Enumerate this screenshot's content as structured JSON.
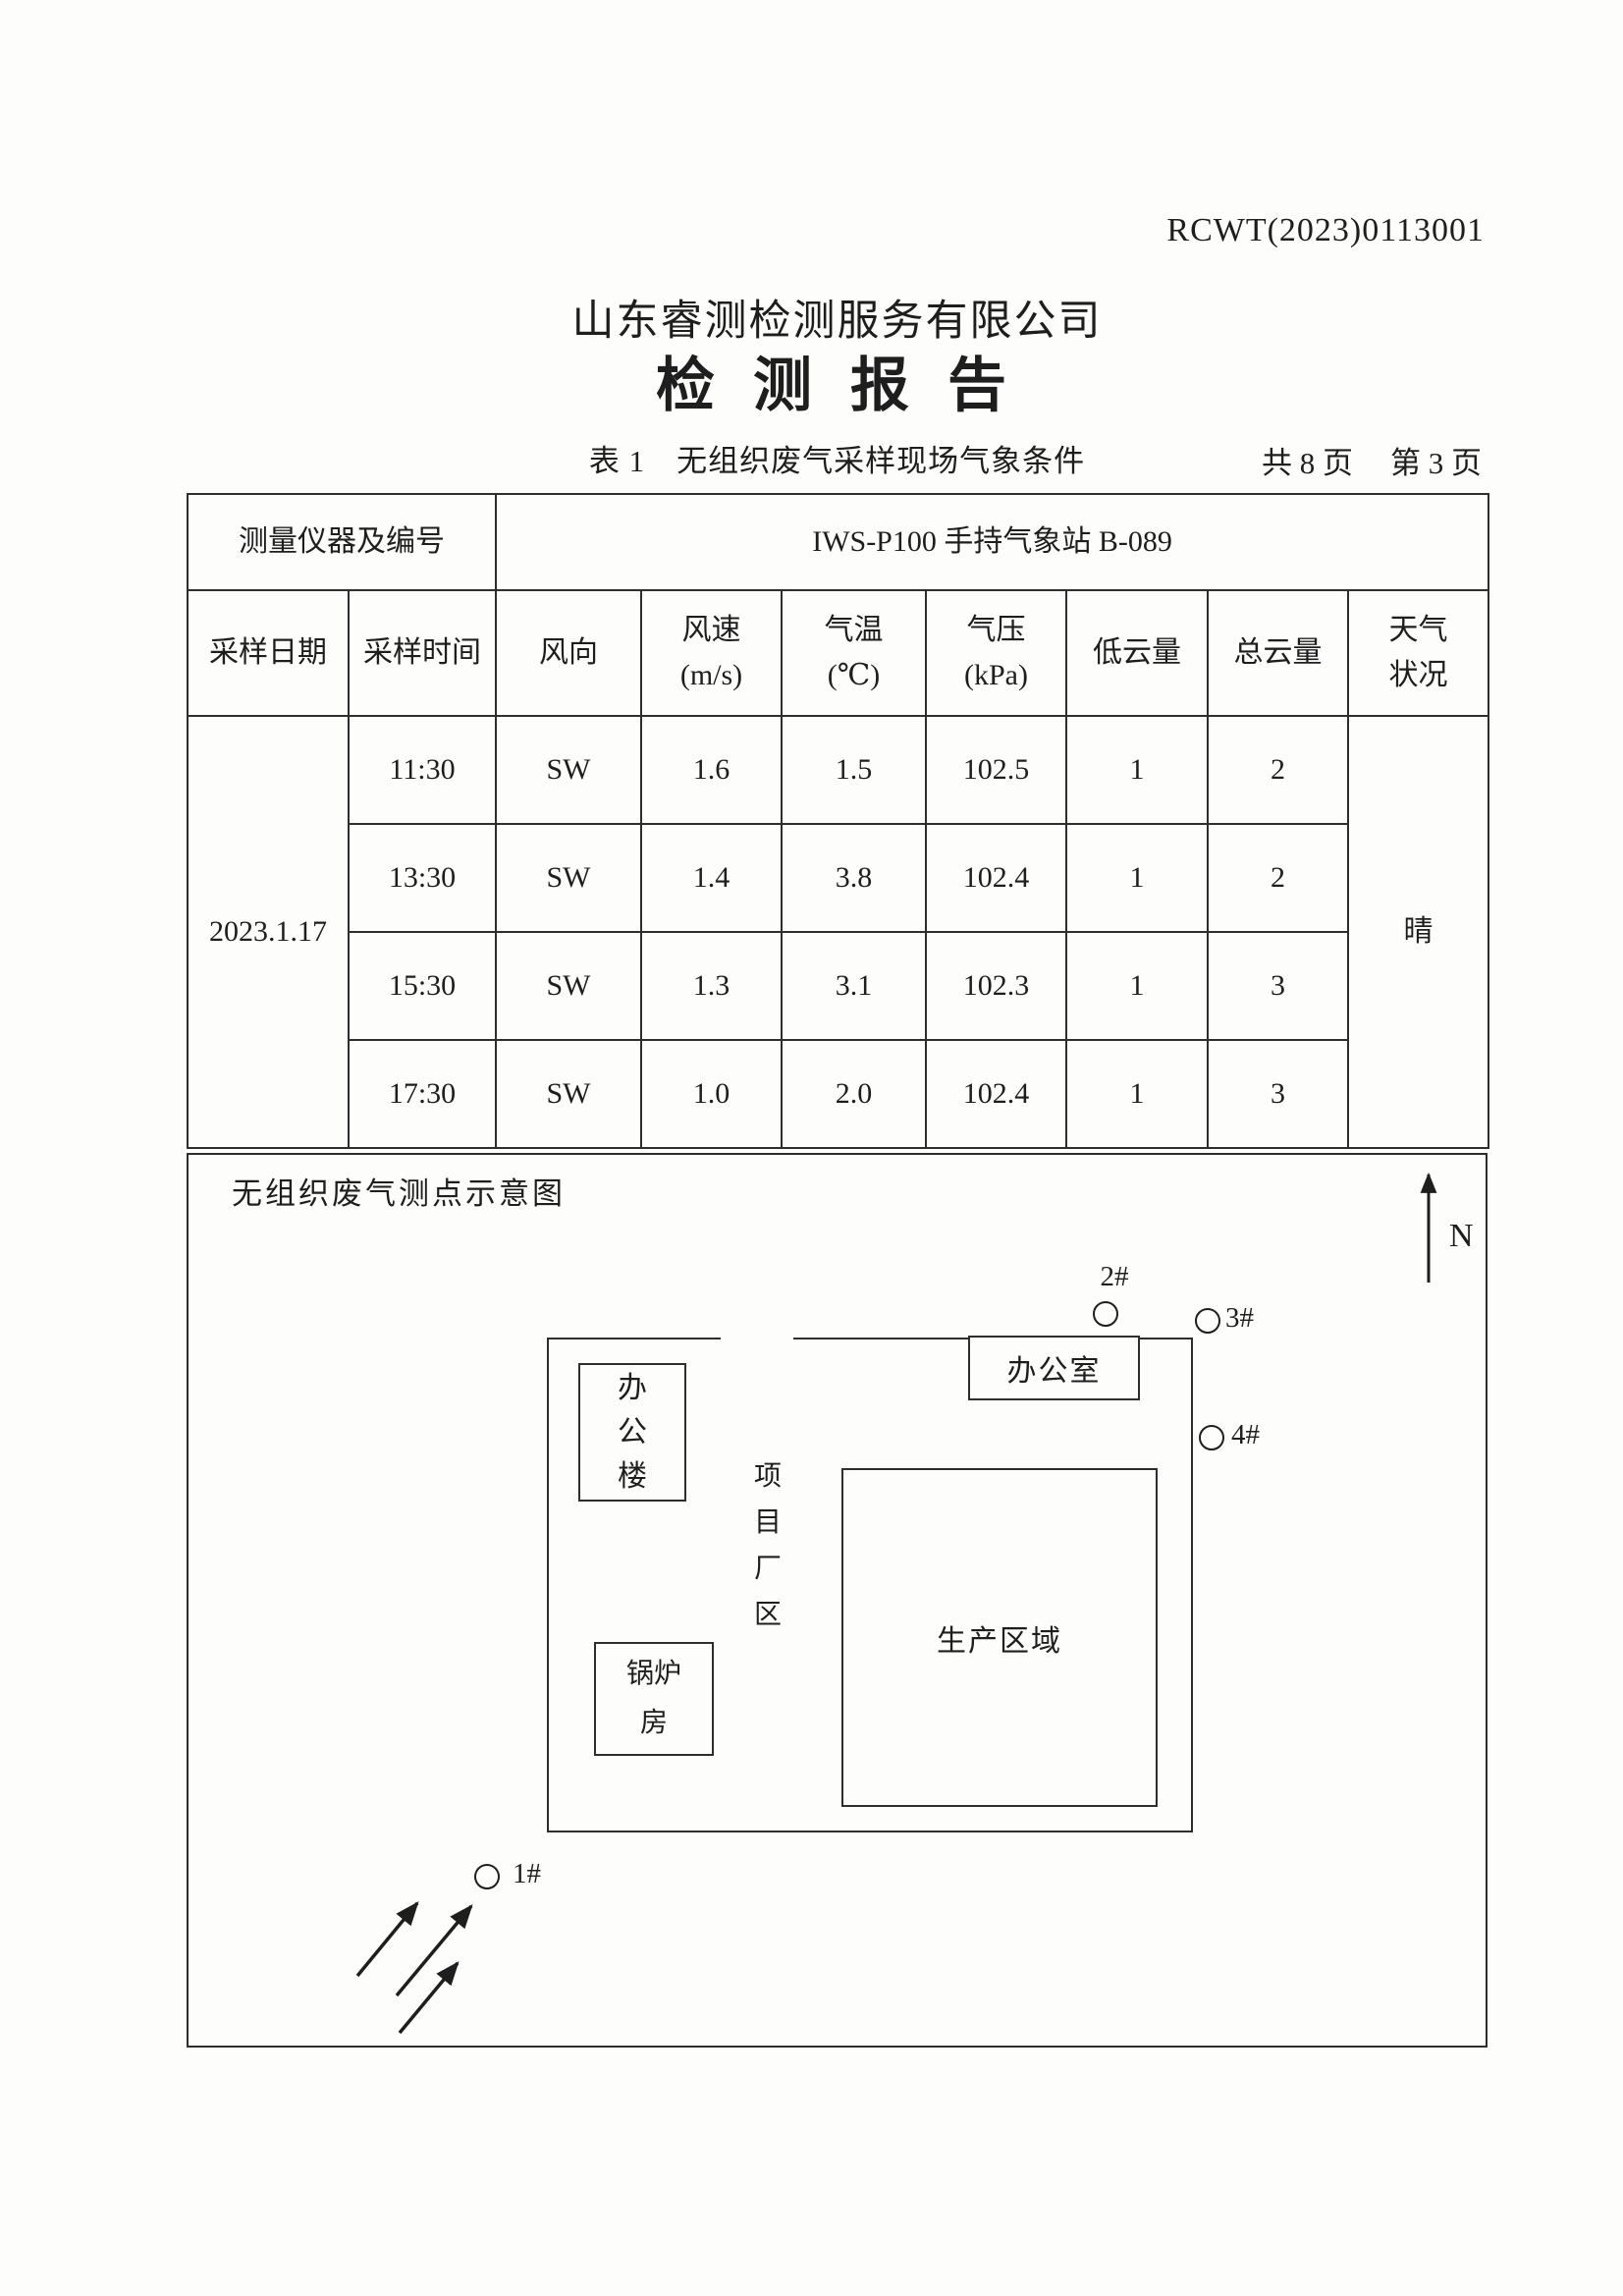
{
  "page": {
    "report_no": "RCWT(2023)0113001",
    "company": "山东睿测检测服务有限公司",
    "title": "检 测 报 告",
    "table_caption": "表 1　无组织废气采样现场气象条件",
    "page_total": "共 8 页",
    "page_current": "第 3 页"
  },
  "table": {
    "instrument_label": "测量仪器及编号",
    "instrument_value": "IWS-P100 手持气象站 B-089",
    "headers": [
      "采样日期",
      "采样时间",
      "风向",
      "风速\n(m/s)",
      "气温\n(℃)",
      "气压\n(kPa)",
      "低云量",
      "总云量",
      "天气\n状况"
    ],
    "date": "2023.1.17",
    "weather": "晴",
    "rows": [
      {
        "time": "11:30",
        "wind_dir": "SW",
        "wind_speed": "1.6",
        "temp": "1.5",
        "pressure": "102.5",
        "low_cloud": "1",
        "total_cloud": "2"
      },
      {
        "time": "13:30",
        "wind_dir": "SW",
        "wind_speed": "1.4",
        "temp": "3.8",
        "pressure": "102.4",
        "low_cloud": "1",
        "total_cloud": "2"
      },
      {
        "time": "15:30",
        "wind_dir": "SW",
        "wind_speed": "1.3",
        "temp": "3.1",
        "pressure": "102.3",
        "low_cloud": "1",
        "total_cloud": "3"
      },
      {
        "time": "17:30",
        "wind_dir": "SW",
        "wind_speed": "1.0",
        "temp": "2.0",
        "pressure": "102.4",
        "low_cloud": "1",
        "total_cloud": "3"
      }
    ]
  },
  "diagram": {
    "caption": "无组织废气测点示意图",
    "north_label": "N",
    "office_building": "办公楼",
    "office_room": "办公室",
    "project_area": "项目厂区",
    "production_area": "生产区域",
    "boiler_room": "锅炉房",
    "point_1": "1#",
    "point_2": "2#",
    "point_3": "3#",
    "point_4": "4#"
  }
}
